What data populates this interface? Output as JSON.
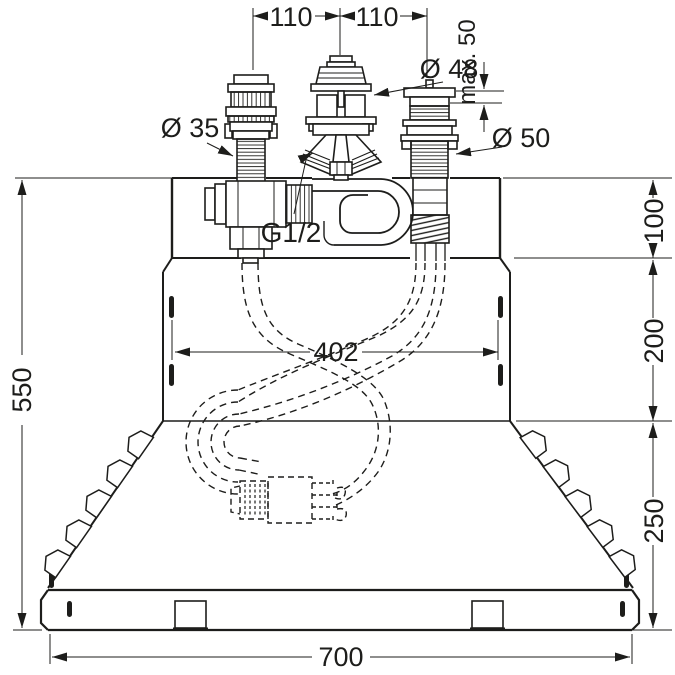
{
  "diagram": {
    "type": "technical installation drawing",
    "subject": "bath-rim faucet basic set with mounting body, three deck fittings, tee piece, coiled hose and dashed hose routing",
    "colors": {
      "line": "#1d1d1b",
      "background": "#ffffff"
    },
    "labels": {
      "spacing_left": "110",
      "spacing_right": "110",
      "dia_center": "Ø 48",
      "max_depth": "max. 50",
      "dia_left": "Ø 35",
      "dia_right": "Ø 50",
      "thread": "G1/2",
      "hole_spacing": "402",
      "offset_top": "100",
      "offset_mid": "200",
      "offset_bottom": "250",
      "total_height": "550",
      "total_width": "700"
    }
  }
}
